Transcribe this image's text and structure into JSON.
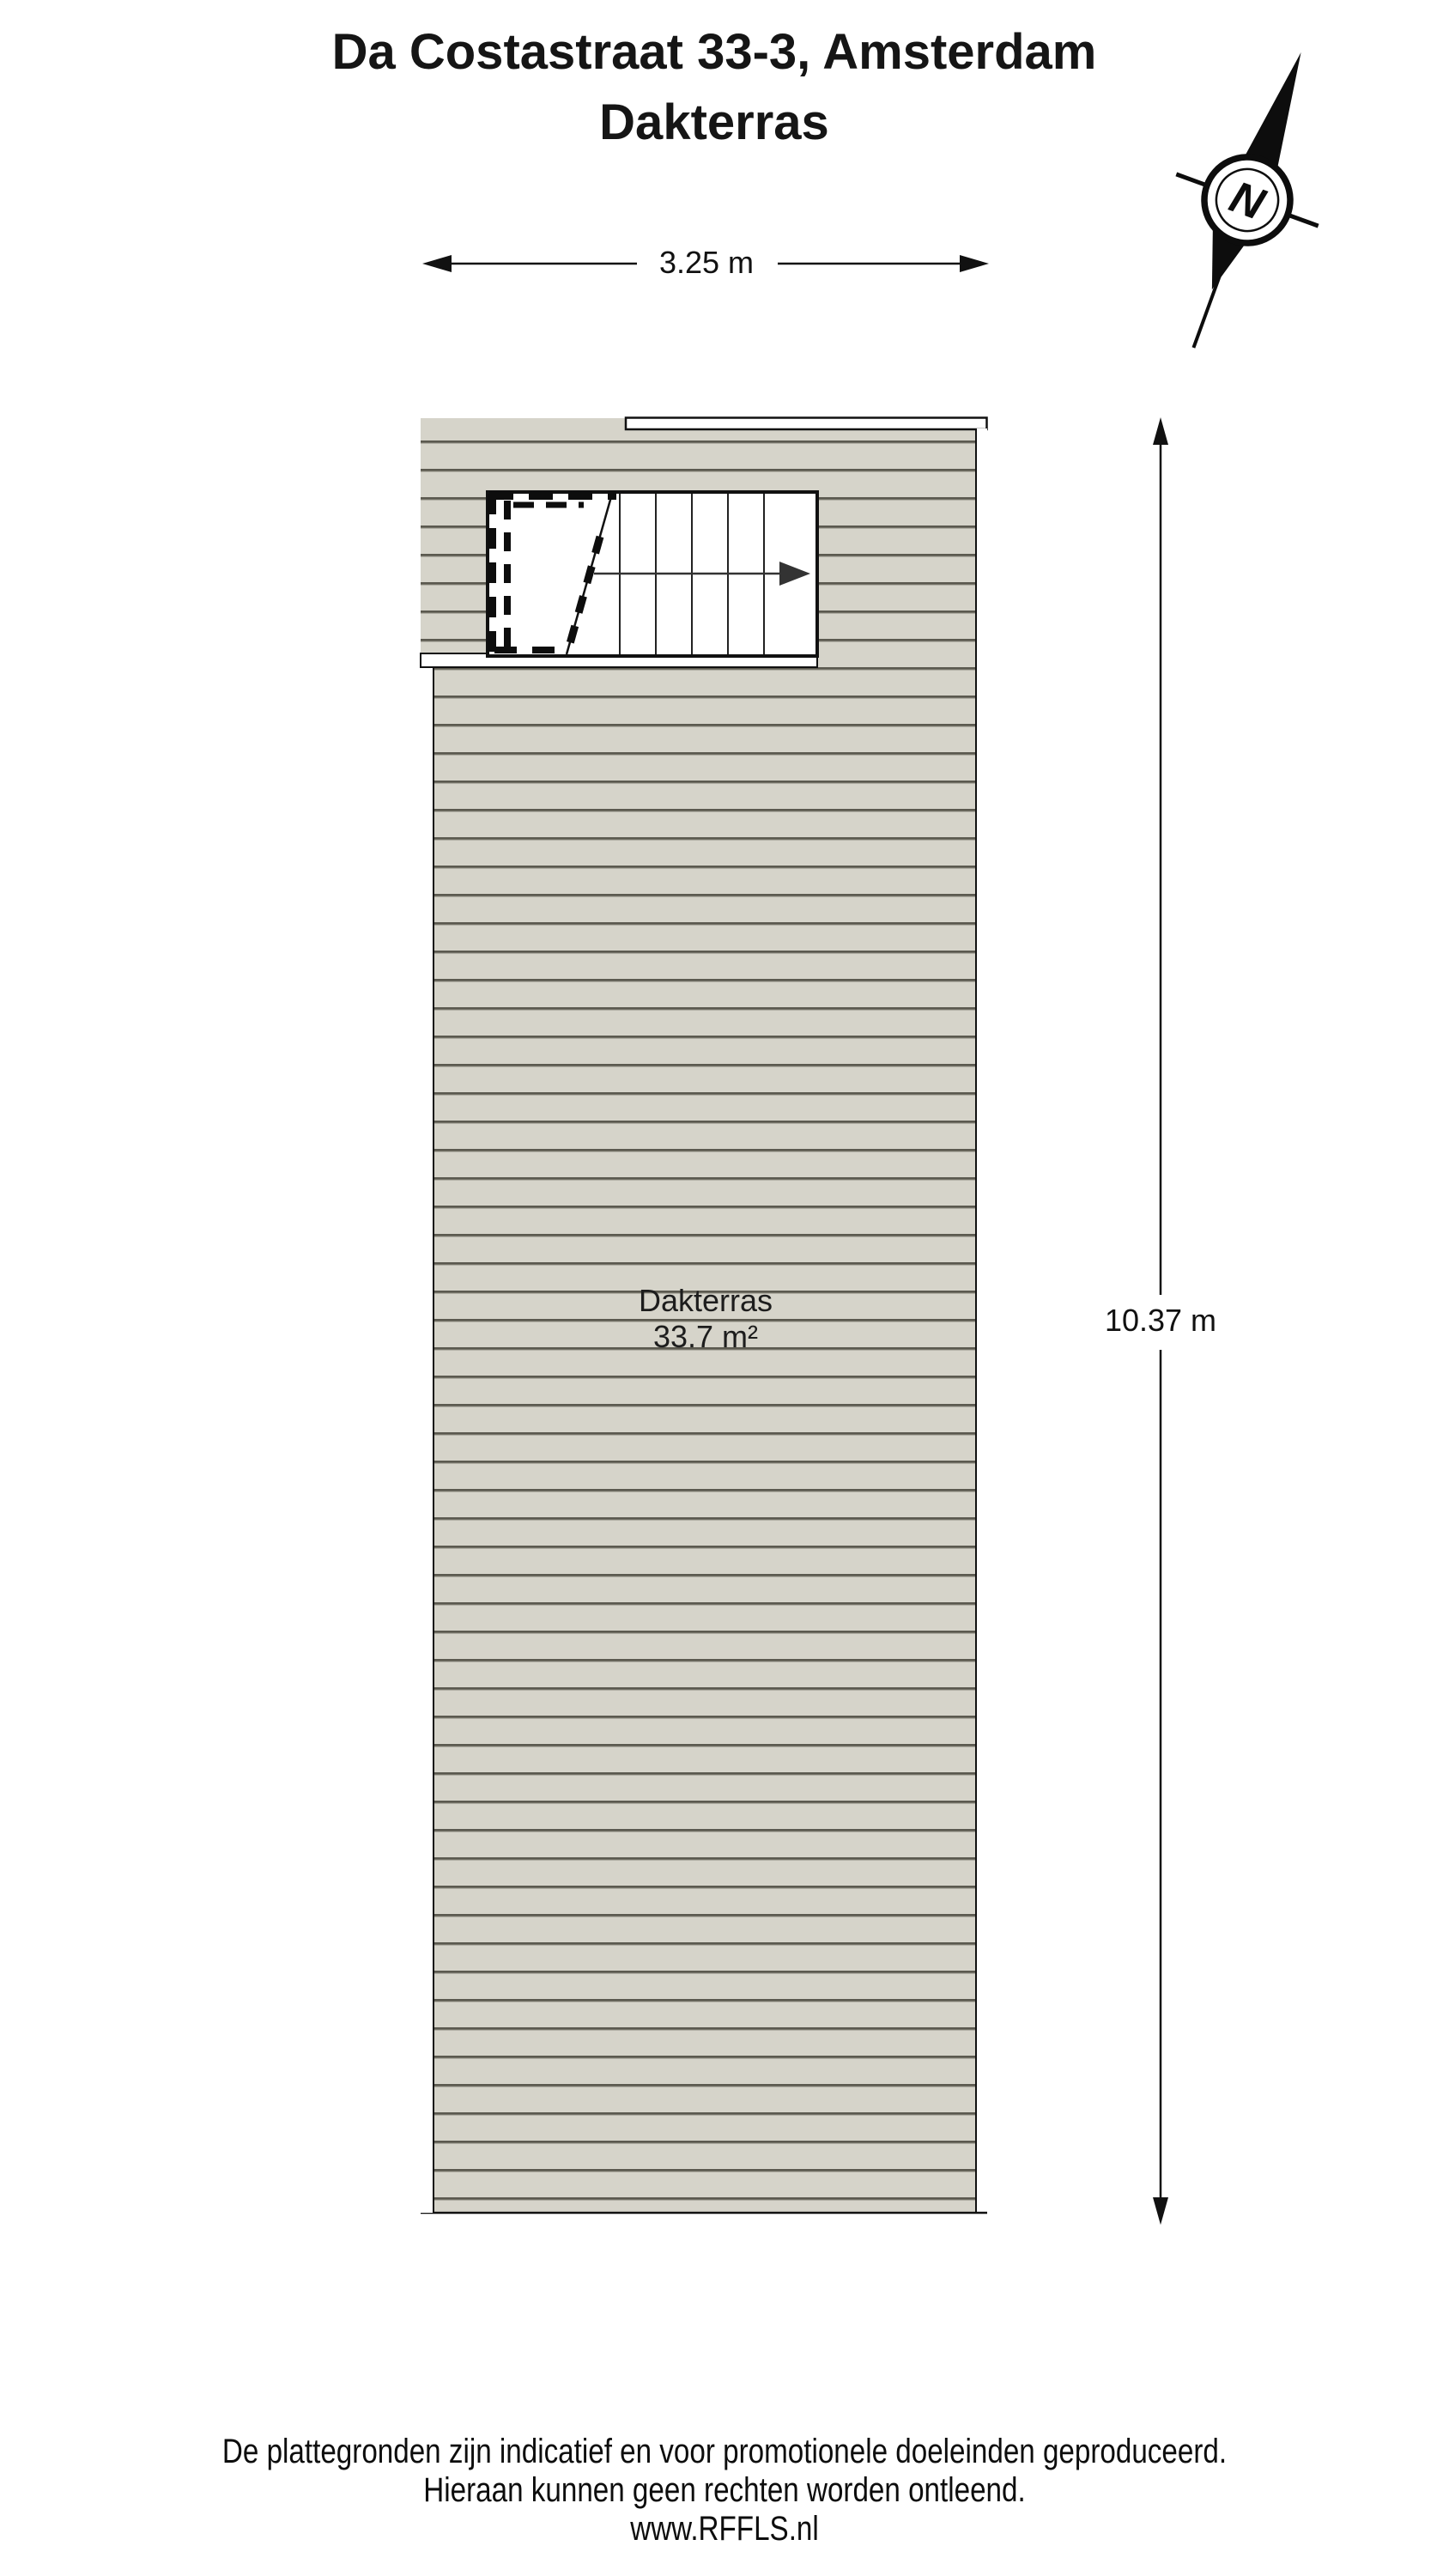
{
  "title": {
    "line1": "Da Costastraat 33-3, Amsterdam",
    "line2": "Dakterras"
  },
  "compass": {
    "letter": "N"
  },
  "dimensions": {
    "width_label": "3.25 m",
    "height_label": "10.37 m"
  },
  "room": {
    "name": "Dakterras",
    "area": "33.7 m²"
  },
  "footer": {
    "lines": [
      "De plattegronden zijn indicatief en voor promotionele doeleinden geproduceerd.",
      "Hieraan kunnen geen rechten worden ontleend.",
      "www.RFFLS.nl"
    ]
  },
  "colors": {
    "deck_fill": "#d6d4ca",
    "deck_line": "#5b594f",
    "outline": "#111111",
    "text": "#151515"
  }
}
